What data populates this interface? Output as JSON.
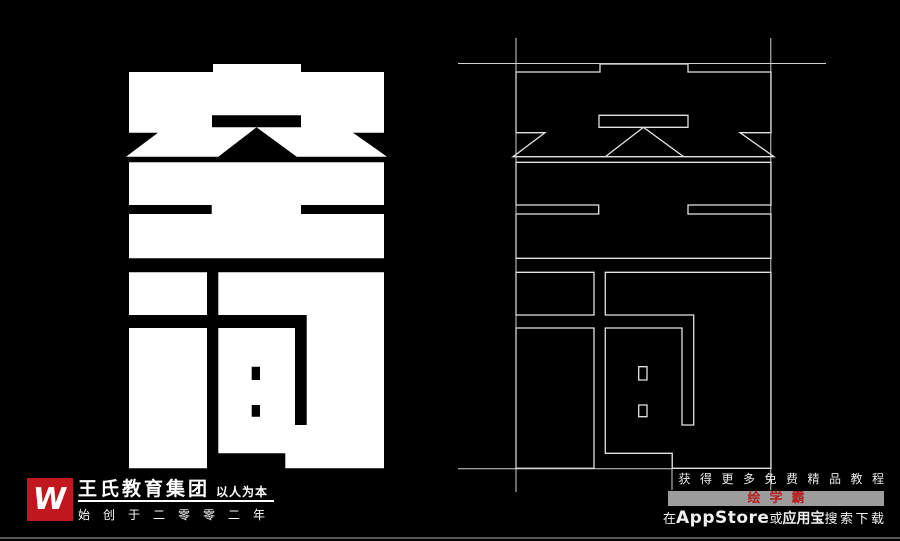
{
  "artwork": {
    "characters": "空间"
  },
  "footer_left": {
    "logo_letter": "W",
    "company": "王氏教育集团",
    "slogan": "以人为本",
    "since": "始创于二零零二年"
  },
  "footer_right": {
    "line1": "获得更多免费精品教程",
    "badge": "绘学霸",
    "line3_prefix": "在",
    "line3_store1": "AppStore",
    "line3_or": "或",
    "line3_store2": "应用宝",
    "line3_suffix": "搜索下载"
  },
  "colors": {
    "background": "#000000",
    "glyph_fill": "#ffffff",
    "wireframe_stroke": "#e2e2e2",
    "brand_red": "#c0181e",
    "badge_bg": "#9c9c9c",
    "badge_text": "#b6201f"
  }
}
